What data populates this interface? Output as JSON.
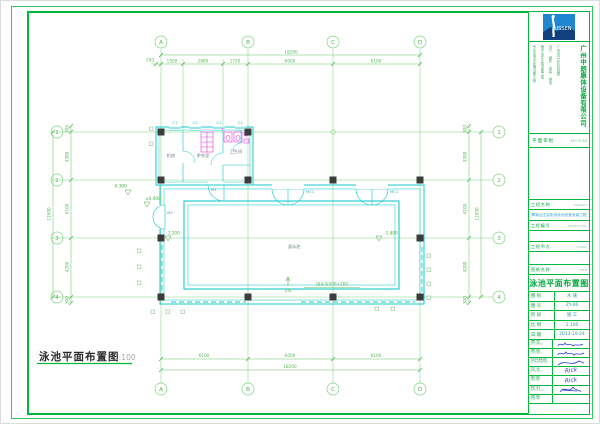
{
  "sheet": {
    "footer_title": "泳池平面布置图",
    "footer_scale": "1:100"
  },
  "grid": {
    "cols": [
      "A",
      "B",
      "C",
      "D"
    ],
    "rows": [
      "1",
      "2",
      "3",
      "4"
    ]
  },
  "dims": {
    "top_overall": "18200",
    "top_seg": [
      "200",
      "1500",
      "2880",
      "1720",
      "6000",
      "6100"
    ],
    "bottom_seg": [
      "6100",
      "6000",
      "6100"
    ],
    "bottom_overall": "18200",
    "left_overall": "11600",
    "left_seg": [
      "300",
      "3300",
      "4100",
      "4200",
      "300"
    ],
    "right_overall": "11600",
    "right_seg": [
      "300",
      "3300",
      "4100",
      "4200",
      "300"
    ]
  },
  "plan": {
    "levels": {
      "outside": "-0.300",
      "entry": "±0.000",
      "pool_shallow": "-1.200",
      "pool_deep": "-1.800"
    },
    "pool_label": "游泳池",
    "drain_label": "排水沟300×200",
    "slope_label": "1%",
    "rooms": [
      "机房",
      "更衣室",
      "卫生间"
    ],
    "doors": {
      "m1": "M1",
      "m2": "M2",
      "mc1a": "MC1",
      "mc1b": "MC1"
    },
    "windows": [
      "C1",
      "C1",
      "C1",
      "C1"
    ]
  },
  "titleblock": {
    "logo_text": "USSEN",
    "company": "广州中朗康体设备有限公司",
    "info_cols": [
      "专业泳池水处理设备工程",
      "桑拿水疗汗蒸设备工程",
      "设计·销售·安装·维保",
      "广州市白云区机场路"
    ],
    "approval_label": "平面审批",
    "approval_value": "KEY PLAN",
    "fields": {
      "name_label": "工程名称",
      "name_en": "PROJECT",
      "project_name": "翠湖山庄会所游泳池设备安装工程",
      "no_label": "工程编号",
      "no_en": "PROJECT NO.",
      "client_label": "工程甲方",
      "client_en": "CLIENT",
      "title_label": "图纸名称",
      "title_en": "TITLE",
      "sheet_title": "泳池平面布置图"
    },
    "meta": [
      {
        "label": "图 别",
        "value": "水 施"
      },
      {
        "label": "图 号",
        "value": "ZY-06"
      },
      {
        "label": "阶 段",
        "value": "施 工"
      },
      {
        "label": "比 例",
        "value": "1:100"
      },
      {
        "label": "日 期",
        "value": "2013-10-24"
      }
    ],
    "signs": [
      {
        "label": "审 定",
        "en": "APPROVED",
        "sig": ""
      },
      {
        "label": "审 核",
        "en": "CHECKED",
        "sig": ""
      },
      {
        "label": "项目经理",
        "en": "PROJ.MANAGER",
        "sig": ""
      },
      {
        "label": "设 计",
        "en": "DESIGNED",
        "sig": "Rick"
      },
      {
        "label": "制 图",
        "en": "DRAWN",
        "sig": "Rick"
      },
      {
        "label": "校 对",
        "en": "PROOFREAD",
        "sig": ""
      },
      {
        "label": "描 图",
        "en": "TRACED",
        "sig": ""
      }
    ]
  },
  "colors": {
    "frame_green": "#00b83e",
    "grid_green": "#7cd67c",
    "dim_green": "#57b857",
    "wall_cyan": "#1ac9c9",
    "fixture_magenta": "#e23ae2",
    "column_dark": "#3c3c3c",
    "sig_blue": "#2b3fd4",
    "logo_blue": "#1f86d0",
    "value_teal": "#1fa0a0"
  }
}
